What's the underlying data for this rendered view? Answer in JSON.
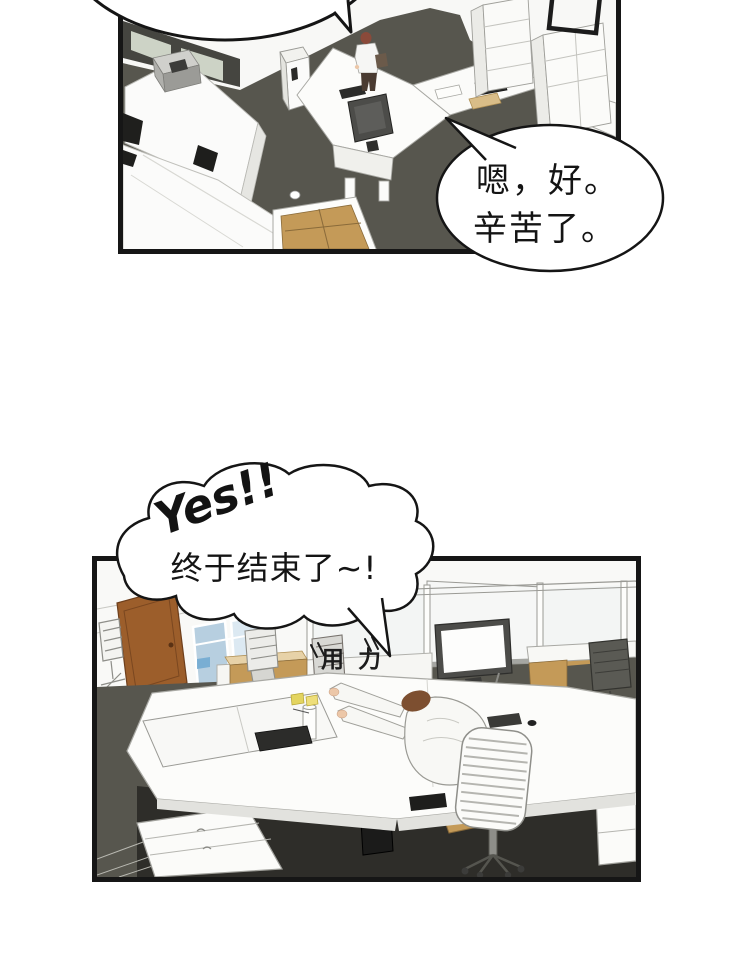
{
  "speech_bubble": {
    "line1": "嗯，好。",
    "line2": "辛苦了。"
  },
  "thought_bubble": {
    "exclaim": "Yes!!",
    "line": "终于结束了~!"
  },
  "sfx": {
    "effort": "用力"
  },
  "colors": {
    "ink": "#161616",
    "floor": "#57564e",
    "floor_dark": "#2e2d29",
    "wall_dark": "#454540",
    "wall_panel": "#cdd3c6",
    "door": "#9c5e2b",
    "window": "#b7cfe0",
    "window_light": "#dce9f2",
    "sky": "#6fa8d0",
    "wood": "#c49a58",
    "wood_light": "#e7d2a8",
    "hair_manager": "#8a4a3a",
    "hair_worker": "#7d4f30",
    "skin": "#ecc7a8",
    "monitor_frame": "#4c4c49",
    "screen": "#fdfdfc",
    "sticky": "#e3d45f",
    "pc_tower": "#1b1b1a",
    "chair_dark": "#5a5a54"
  }
}
